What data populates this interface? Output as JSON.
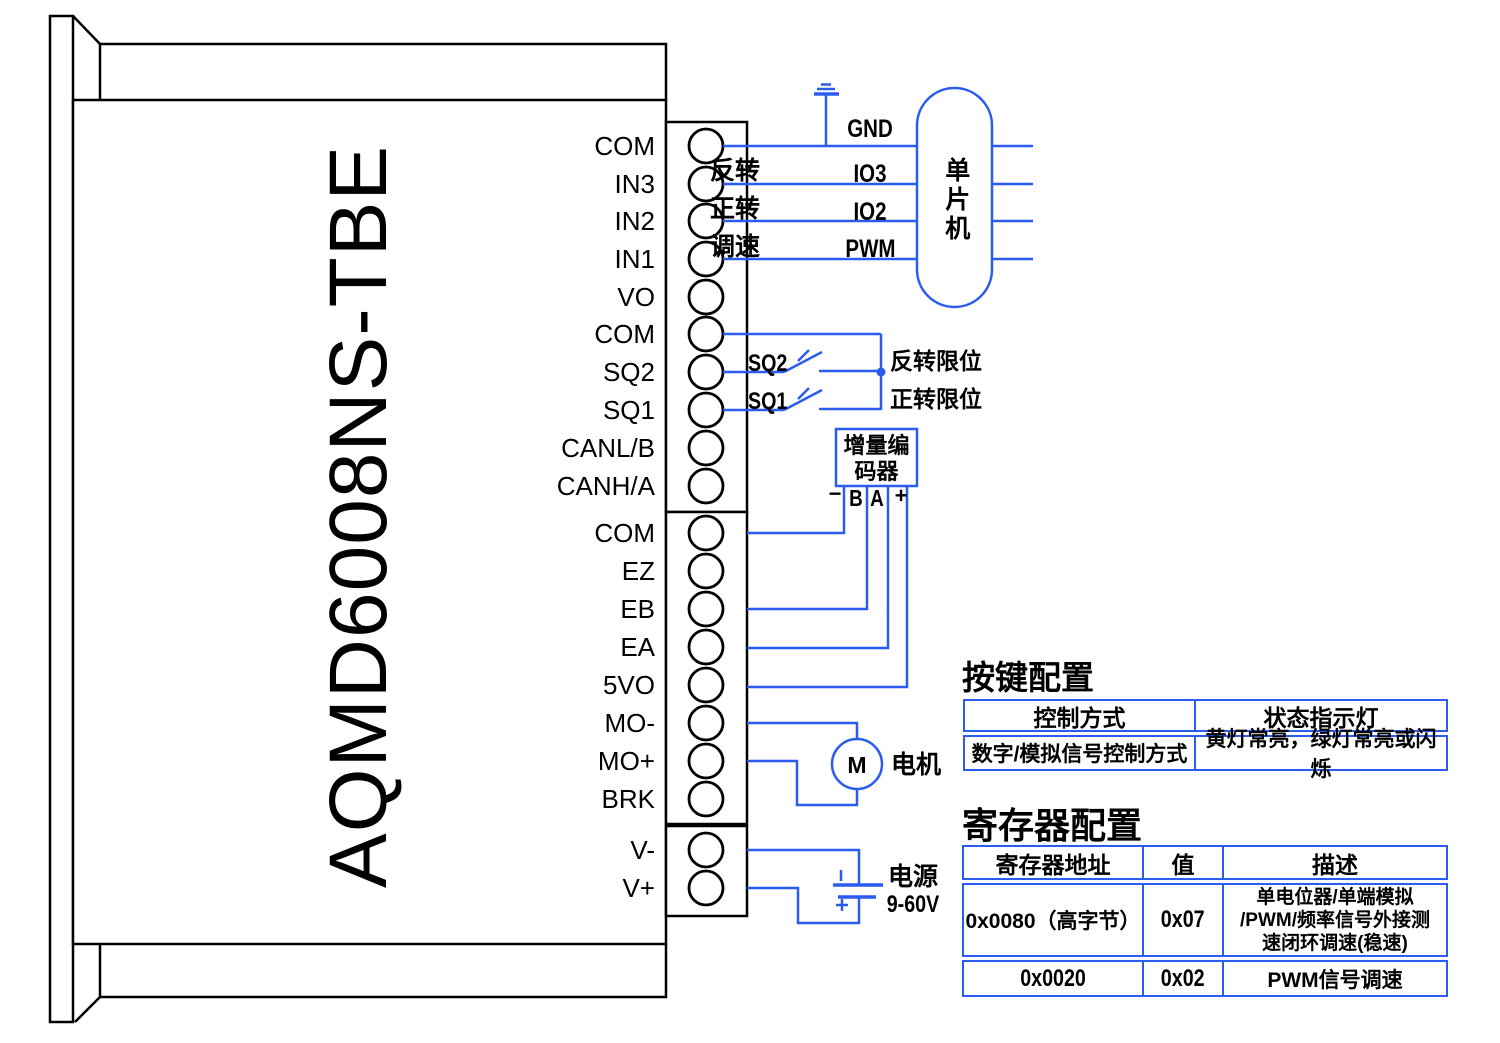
{
  "colors": {
    "wire": "#2b5cf0",
    "ink": "#000000"
  },
  "device": {
    "model": "AQMD6008NS-TBE",
    "terminals": [
      "COM",
      "IN3",
      "IN2",
      "IN1",
      "VO",
      "COM",
      "SQ2",
      "SQ1",
      "CANL/B",
      "CANH/A",
      "COM",
      "EZ",
      "EB",
      "EA",
      "5VO",
      "MO-",
      "MO+",
      "BRK",
      "V-",
      "V+"
    ]
  },
  "mcu": {
    "label": "单片机",
    "gnd": "GND",
    "rows": [
      {
        "action": "反转",
        "pin": "IO3"
      },
      {
        "action": "正转",
        "pin": "IO2"
      },
      {
        "action": "调速",
        "pin": "PWM"
      }
    ]
  },
  "limits": {
    "sq2": {
      "name": "SQ2",
      "desc": "反转限位"
    },
    "sq1": {
      "name": "SQ1",
      "desc": "正转限位"
    }
  },
  "encoder": {
    "label": "增量编\n码器",
    "pin_minus": "−",
    "pin_b": "B",
    "pin_a": "A",
    "pin_plus": "+"
  },
  "motor": {
    "symbol": "M",
    "label": "电机"
  },
  "power": {
    "label": "电源",
    "range": "9-60V"
  },
  "tables": {
    "keys": {
      "title": "按键配置",
      "headers": [
        "控制方式",
        "状态指示灯"
      ],
      "rows": [
        [
          "数字/模拟信号控制方式",
          "黄灯常亮，绿灯常亮或闪烁"
        ]
      ]
    },
    "regs": {
      "title": "寄存器配置",
      "headers": [
        "寄存器地址",
        "值",
        "描述"
      ],
      "rows": [
        [
          "0x0080（高字节）",
          "0x07",
          "单电位器/单端模拟\n/PWM/频率信号外接测\n速闭环调速(稳速)"
        ],
        [
          "0x0020",
          "0x02",
          "PWM信号调速"
        ]
      ]
    }
  }
}
